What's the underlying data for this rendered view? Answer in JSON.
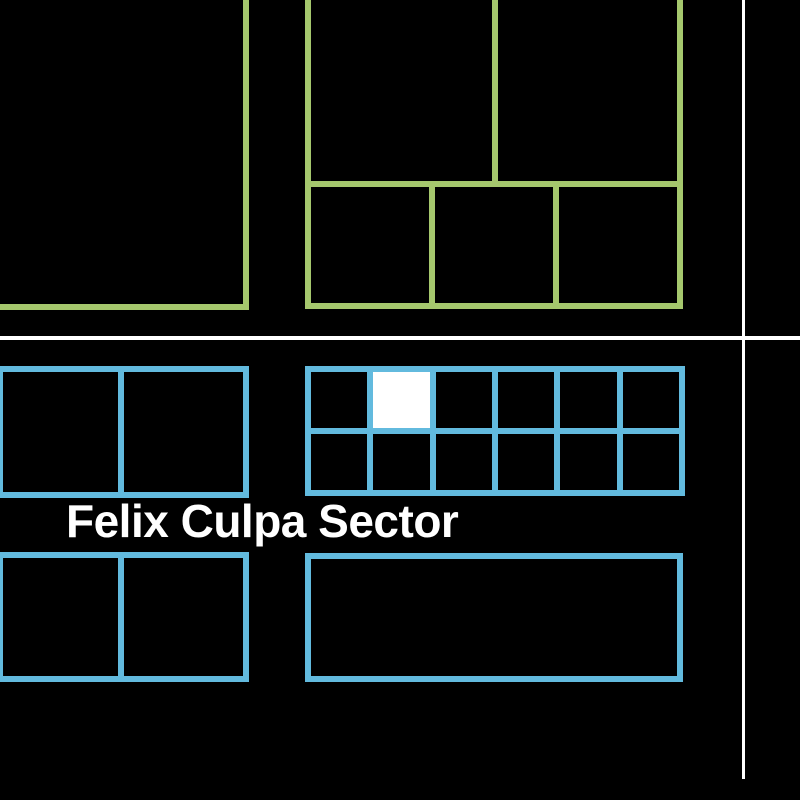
{
  "map": {
    "sector_label": "Felix Culpa Sector",
    "colors": {
      "background": "#000000",
      "room_green": "#a5c76d",
      "room_blue": "#62bade",
      "divider_white": "#ffffff",
      "highlight_cell": "#ffffff"
    },
    "grid": {
      "columns": 6,
      "rows": 2,
      "highlight": {
        "row": 0,
        "col": 1
      }
    }
  }
}
